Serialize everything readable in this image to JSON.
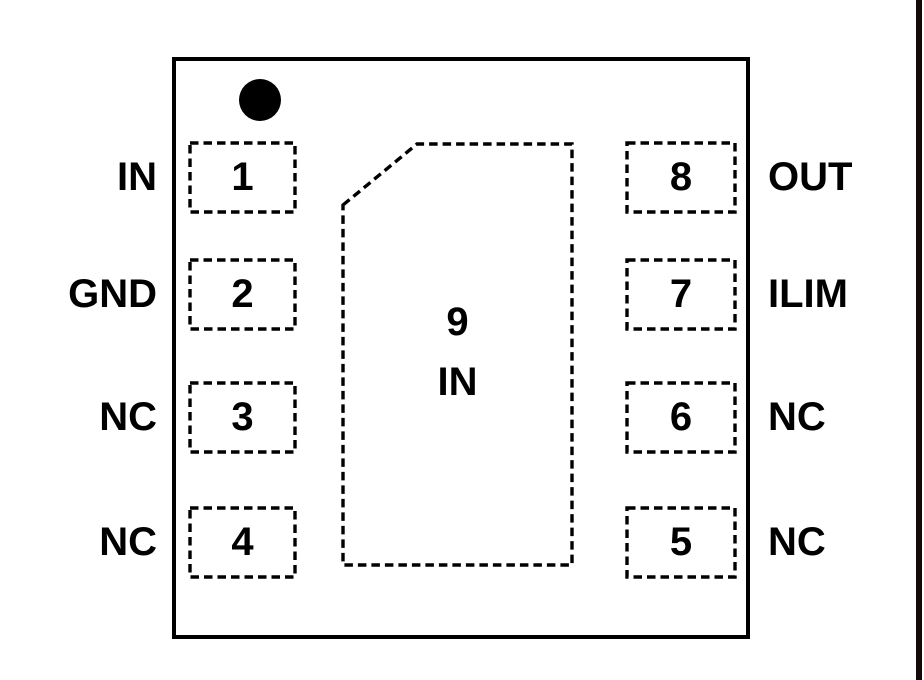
{
  "diagram": {
    "kind": "ic-package-pinout",
    "colors": {
      "background": "#ffffff",
      "line": "#000000",
      "text": "#000000",
      "page_edge_bar": "#140a0a"
    }
  },
  "pins": {
    "left": [
      {
        "number": "1",
        "name": "IN"
      },
      {
        "number": "2",
        "name": "GND"
      },
      {
        "number": "3",
        "name": "NC"
      },
      {
        "number": "4",
        "name": "NC"
      }
    ],
    "right": [
      {
        "number": "8",
        "name": "OUT"
      },
      {
        "number": "7",
        "name": "ILIM"
      },
      {
        "number": "6",
        "name": "NC"
      },
      {
        "number": "5",
        "name": "NC"
      }
    ],
    "pad": {
      "number": "9",
      "name": "IN"
    }
  }
}
